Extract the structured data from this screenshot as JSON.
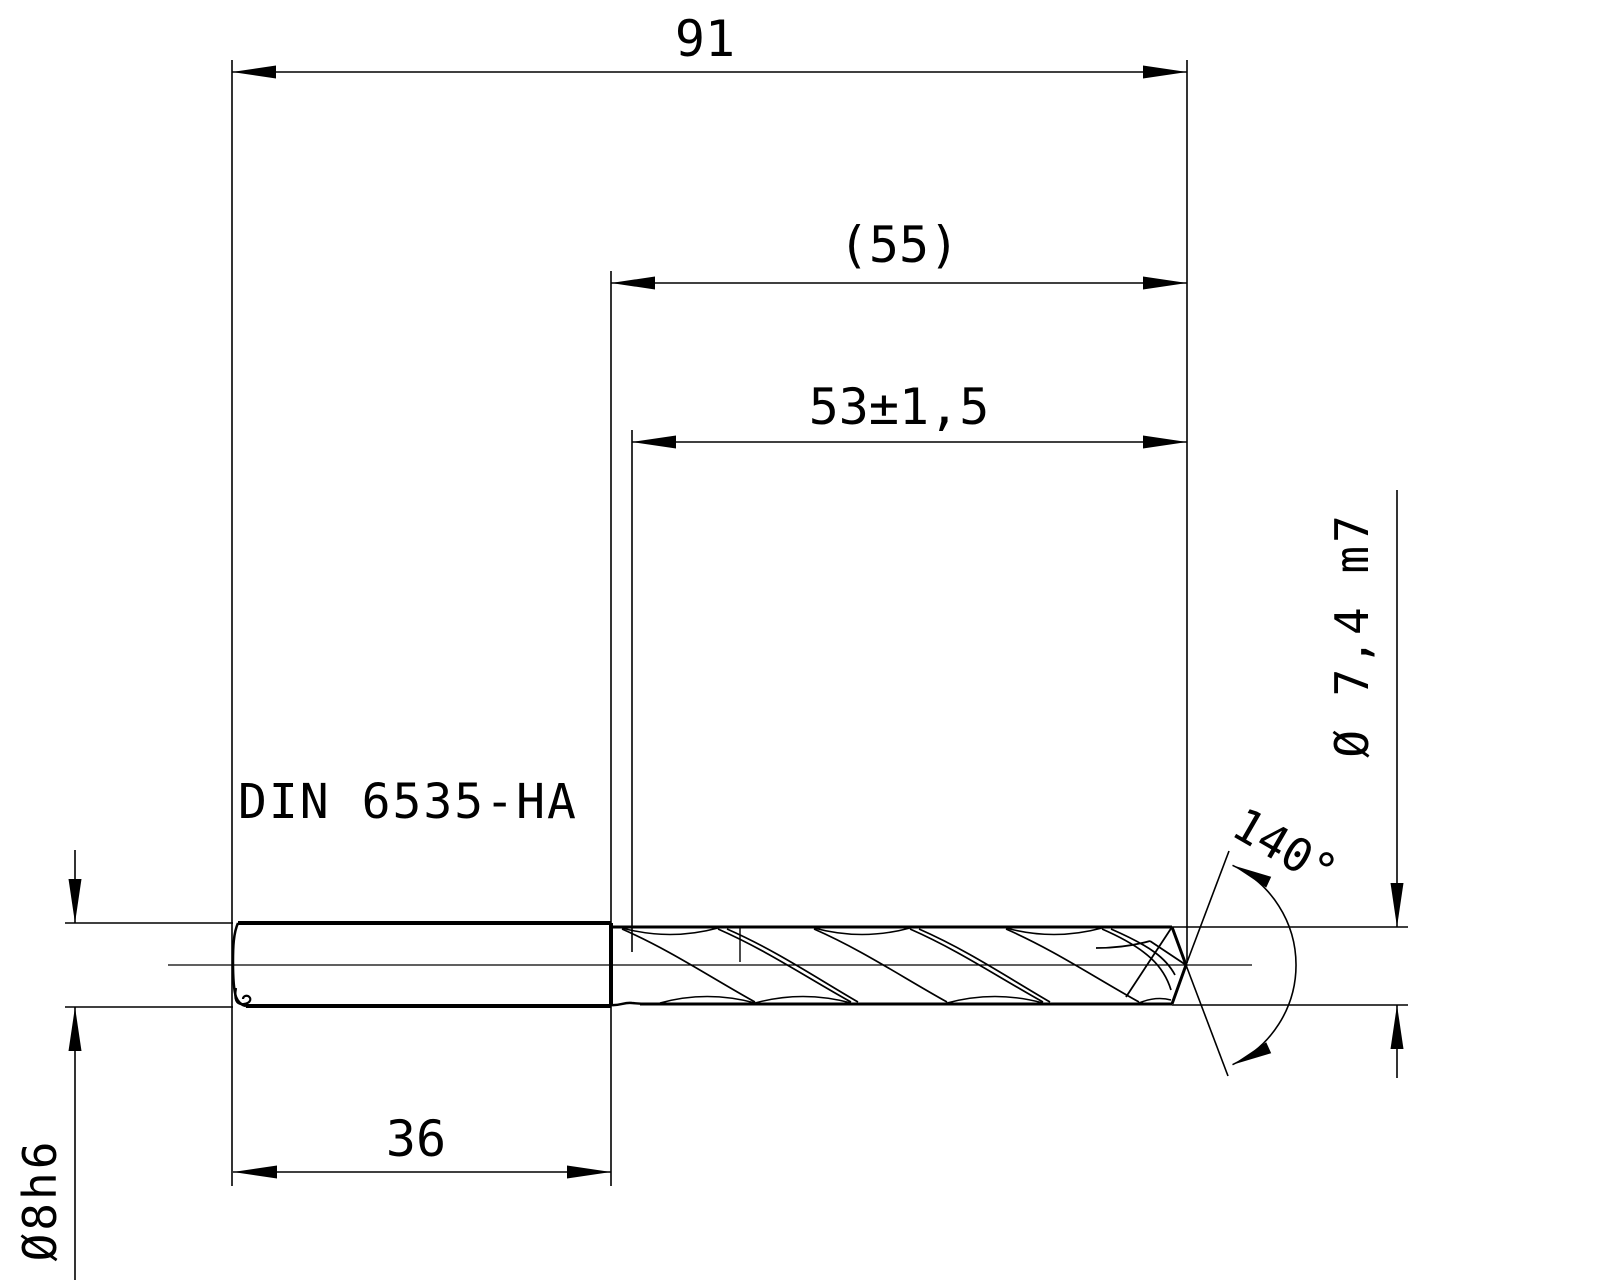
{
  "drawing": {
    "type": "technical-dimension-drawing",
    "subject": "twist-drill-side-view",
    "shank_standard_label": "DIN 6535-HA",
    "dims": {
      "overall_length": "91",
      "flute_length_ref": "(55)",
      "usable_length_tol": "53±1,5",
      "shank_length": "36",
      "shank_diameter": "Ø8h6",
      "cutting_diameter": "Ø 7,4 m7",
      "point_angle": "140°"
    },
    "colors": {
      "line": "#000000",
      "background": "#ffffff"
    }
  }
}
